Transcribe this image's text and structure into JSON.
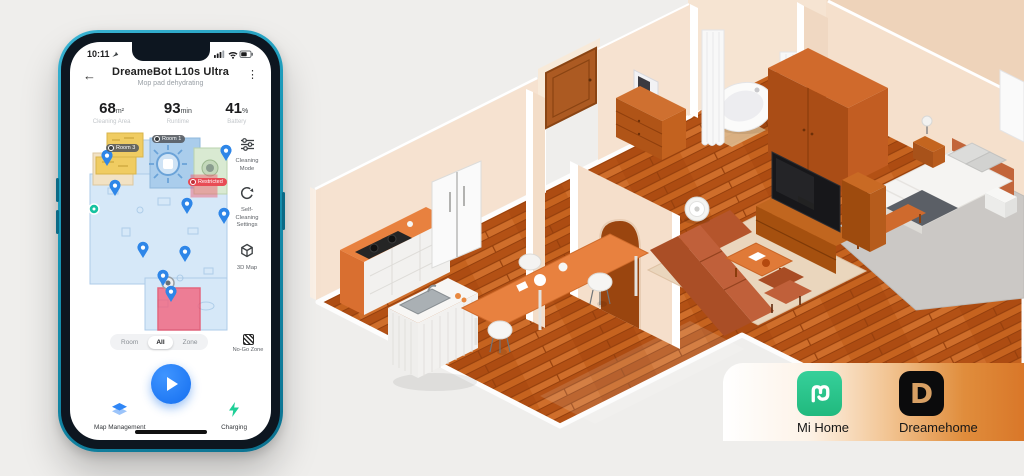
{
  "phone": {
    "status_bar": {
      "time": "10:11"
    },
    "header": {
      "back_icon": "←",
      "title": "DreameBot L10s Ultra",
      "subtitle": "Mop pad dehydrating",
      "menu_icon": "⋮"
    },
    "stats": [
      {
        "value": "68",
        "unit": "m²",
        "label": "Cleaning Area"
      },
      {
        "value": "93",
        "unit": "min",
        "label": "Runtime"
      },
      {
        "value": "41",
        "unit": "%",
        "label": "Battery"
      }
    ],
    "map": {
      "room_labels": [
        {
          "text": "Room 3"
        },
        {
          "text": "Room 1"
        }
      ],
      "restricted_label": "Restricted"
    },
    "map_buttons": [
      {
        "label": "Cleaning Mode"
      },
      {
        "label": "Self-Cleaning Settings"
      },
      {
        "label": "3D Map"
      }
    ],
    "mode_tabs": {
      "options": [
        "Room",
        "All",
        "Zone"
      ],
      "selected": "All"
    },
    "no_go_zone": {
      "label": "No-Go Zone"
    },
    "bottom_nav": [
      {
        "label": "Map Management"
      },
      {
        "label": "Charging"
      }
    ]
  },
  "badge": {
    "apps": [
      {
        "name": "Mi Home"
      },
      {
        "name": "Dreamehome",
        "letter": "D"
      }
    ]
  },
  "colors": {
    "accent_blue": "#1f7bf4",
    "phone_frame_teal": "#1795b4",
    "mi_home_green": "#2fc48b",
    "dreamehome_gold": "#d8a064",
    "card_orange": "#dd7f33",
    "no_go_red": "#f0556a",
    "dock_teal": "#16c2a0"
  }
}
